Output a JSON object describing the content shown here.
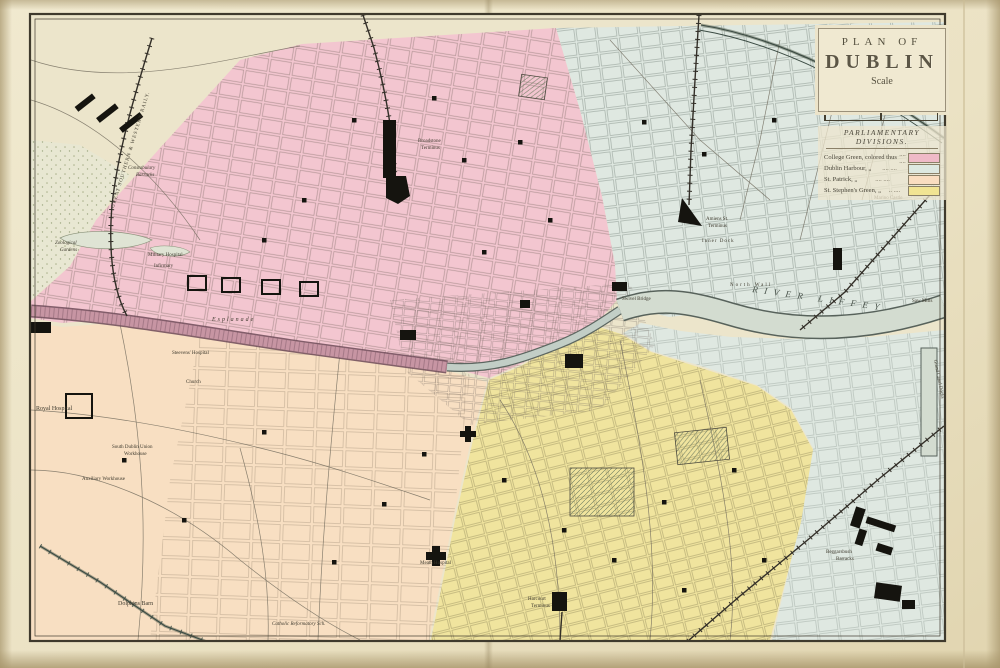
{
  "title_panel": {
    "line1": "PLAN OF",
    "line2": "DUBLIN",
    "scale_label": "Scale"
  },
  "legend": {
    "heading": "PARLIAMENTARY DIVISIONS.",
    "rows": [
      {
        "name": "College Green, colored thus",
        "dots": ".... ....",
        "color": "#efbac7"
      },
      {
        "name": "Dublin Harbour,        „",
        "dots": ".... ....",
        "color": "#dde8e0"
      },
      {
        "name": "St. Patrick,             „",
        "dots": ".... ....",
        "color": "#f9ddc0"
      },
      {
        "name": "St. Stephen's Green,  „",
        "dots": "..  ....",
        "color": "#f1e493"
      }
    ]
  },
  "districts": [
    {
      "name": "College Green",
      "color": "#f3c6d0"
    },
    {
      "name": "Dublin Harbour",
      "color": "#dfe8e1"
    },
    {
      "name": "St. Patrick",
      "color": "#f8dfc2"
    },
    {
      "name": "St. Stephen's Green",
      "color": "#f0e49e"
    }
  ],
  "map_labels": [
    {
      "text": "RIVER  LIFFEY"
    },
    {
      "text": "Broadstone"
    },
    {
      "text": "Terminus"
    },
    {
      "text": "Amiens St."
    },
    {
      "text": "Terminus"
    },
    {
      "text": "Harcourt"
    },
    {
      "text": "Terminus"
    },
    {
      "text": "Royal Hospital"
    },
    {
      "text": "South Dublin Union"
    },
    {
      "text": "Workhouse"
    },
    {
      "text": "Auxiliary Workhouse"
    },
    {
      "text": "Constabulary"
    },
    {
      "text": "Barracks"
    },
    {
      "text": "Dolphins Barn"
    },
    {
      "text": "Meath Hospital"
    },
    {
      "text": "Beggarsbush"
    },
    {
      "text": "Barracks"
    },
    {
      "text": "Zoological"
    },
    {
      "text": "Gardens"
    },
    {
      "text": "Steevens' Hospital"
    },
    {
      "text": "Military Hospital"
    },
    {
      "text": "Infirmary"
    },
    {
      "text": "Esplanade"
    },
    {
      "text": "Saw Mills"
    },
    {
      "text": "Marino Castle"
    },
    {
      "text": "Swivel Bridge"
    },
    {
      "text": "Inner Dock"
    },
    {
      "text": "GREAT SOUTHERN & WESTERN RAILY."
    },
    {
      "text": "North Wall"
    },
    {
      "text": "Grand Canal Docks"
    },
    {
      "text": "Church"
    },
    {
      "text": "Catholic Reformatory Sch."
    }
  ]
}
